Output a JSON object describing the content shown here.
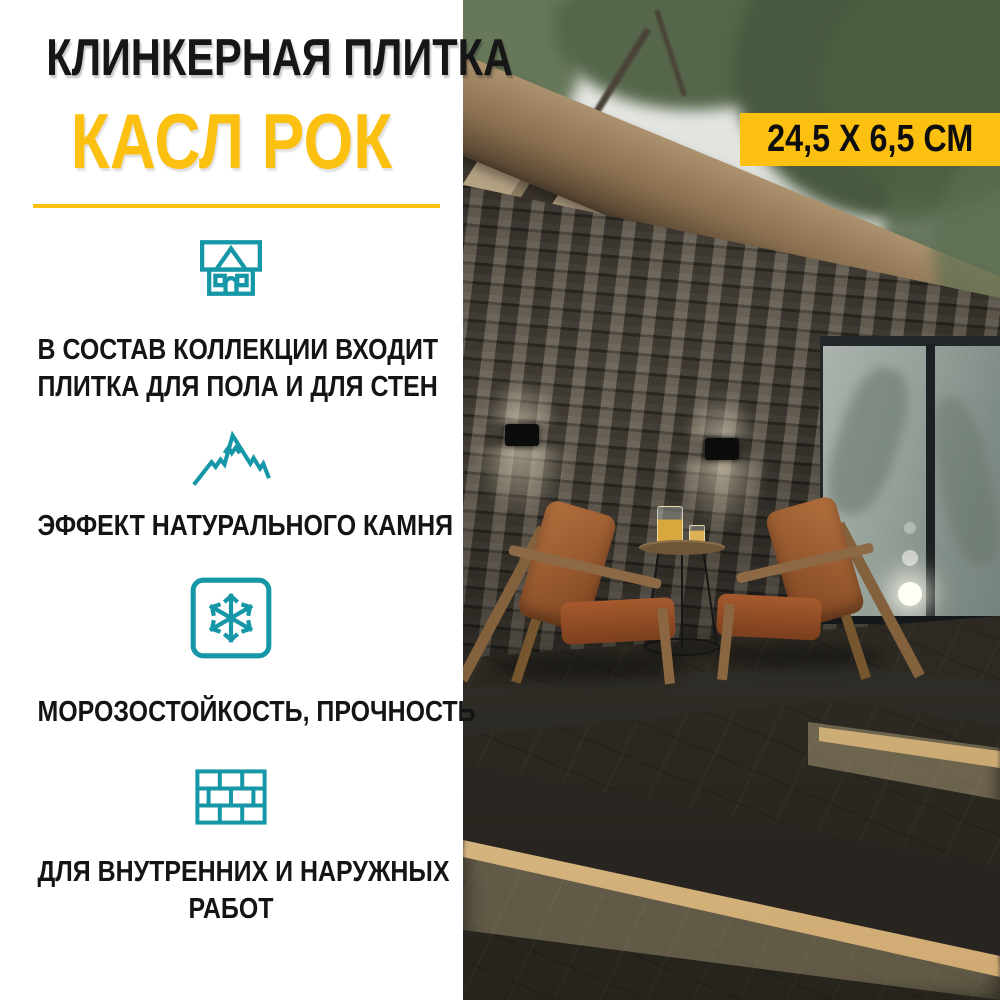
{
  "title": {
    "line1": "КЛИНКЕРНАЯ ПЛИТКА",
    "line2": "КАСЛ РОК"
  },
  "badge": {
    "text": "24,5 Х 6,5 СМ"
  },
  "features": [
    {
      "icon": "house-icon",
      "line1": "В СОСТАВ КОЛЛЕКЦИИ ВХОДИТ",
      "line2": "ПЛИТКА ДЛЯ ПОЛА И ДЛЯ СТЕН"
    },
    {
      "icon": "mountain-icon",
      "line1": "ЭФФЕКТ НАТУРАЛЬНОГО КАМНЯ",
      "line2": ""
    },
    {
      "icon": "snowflake-icon",
      "line1": "МОРОЗОСТОЙКОСТЬ, ПРОЧНОСТЬ",
      "line2": ""
    },
    {
      "icon": "brick-wall-icon",
      "line1": "ДЛЯ ВНУТРЕННИХ И НАРУЖНЫХ",
      "line2": "РАБОТ"
    }
  ],
  "colors": {
    "accent_yellow": "#FCC010",
    "icon_teal": "#1697A7",
    "title_black": "#161616"
  }
}
